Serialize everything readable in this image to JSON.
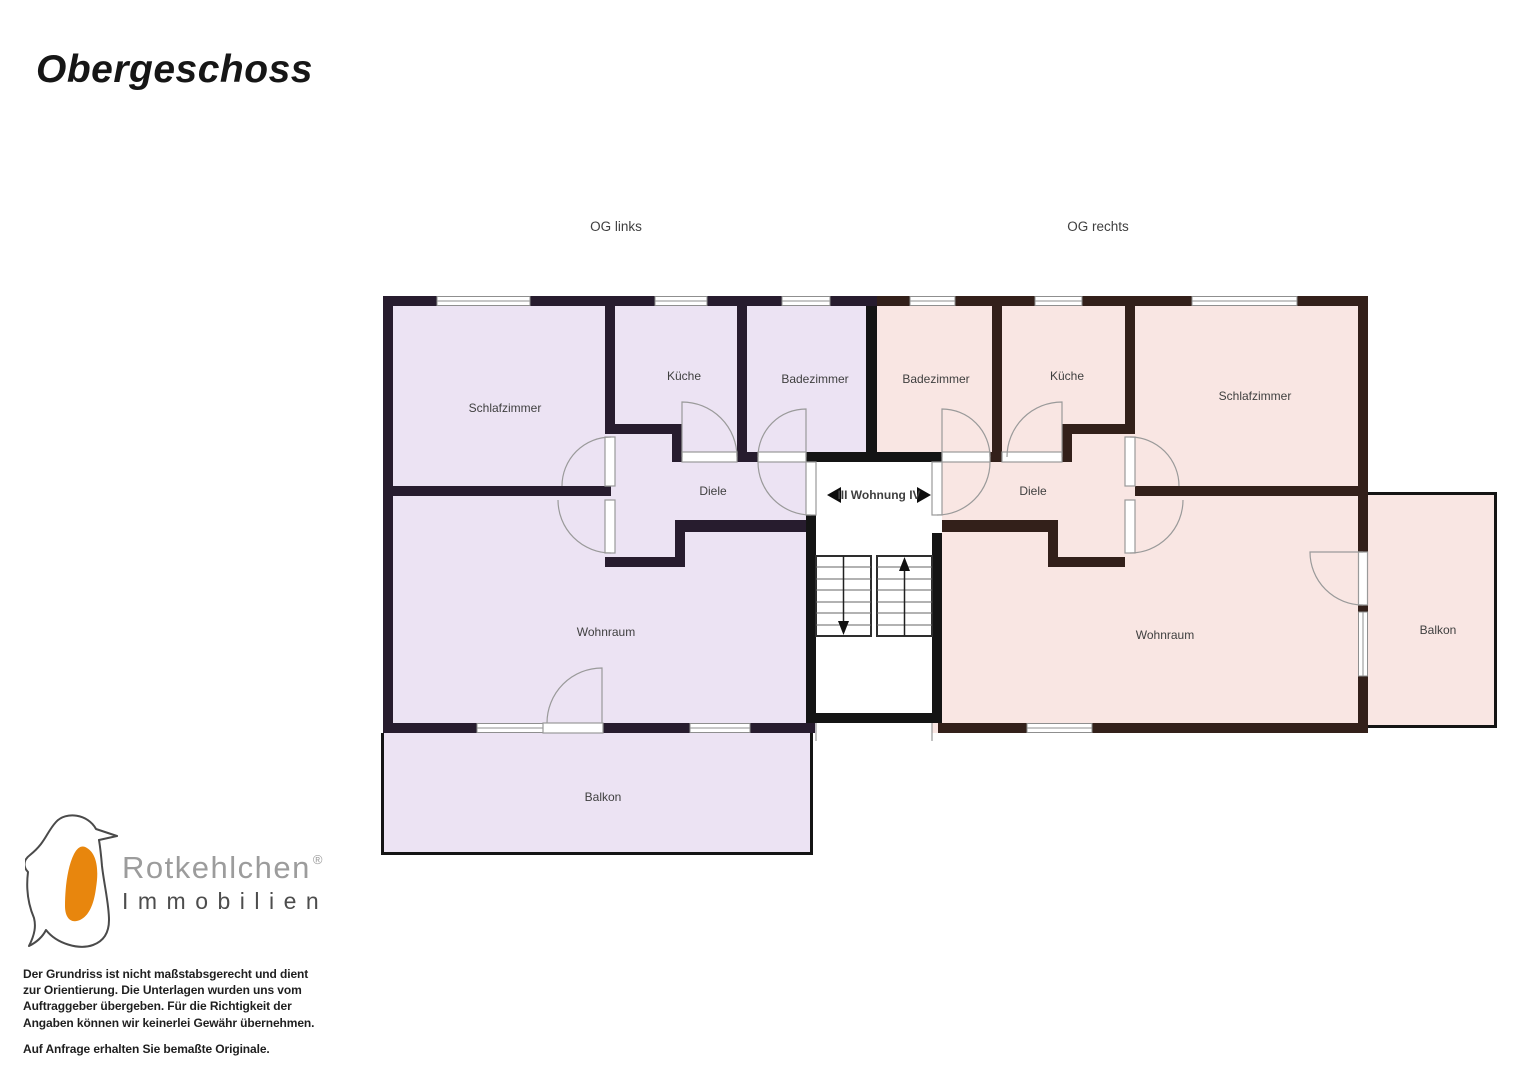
{
  "page": {
    "title": "Obergeschoss"
  },
  "plan": {
    "og_links": "OG links",
    "og_rechts": "OG rechts",
    "stairwell_label": "III Wohnung IV",
    "left": {
      "schlafzimmer": "Schlafzimmer",
      "kueche": "Küche",
      "badezimmer": "Badezimmer",
      "diele": "Diele",
      "wohnraum": "Wohnraum",
      "balkon": "Balkon"
    },
    "right": {
      "badezimmer": "Badezimmer",
      "kueche": "Küche",
      "schlafzimmer": "Schlafzimmer",
      "diele": "Diele",
      "wohnraum": "Wohnraum",
      "balkon": "Balkon"
    }
  },
  "colors": {
    "left_apartment_fill": "#ece3f3",
    "left_apartment_wall": "#271c2e",
    "right_apartment_fill": "#f9e6e3",
    "right_apartment_wall": "#33201a",
    "stair_wall": "#141414",
    "logo_orange": "#e8860d"
  },
  "icons": {
    "wohnung_arrow_left": "◀",
    "wohnung_arrow_right": "▶",
    "stairs_up_arrow": "↑",
    "stairs_down_arrow": "↓",
    "bird_logo": "rotkehlchen-bird"
  },
  "logo": {
    "brand": "Rotkehlchen",
    "registered": "®",
    "line2": "Immobilien"
  },
  "disclaimer": {
    "paragraph1": "Der Grundriss ist nicht maßstabsgerecht und dient\nzur Orientierung. Die Unterlagen wurden uns vom\nAuftraggeber übergeben. Für die Richtigkeit der\nAngaben können wir keinerlei Gewähr übernehmen.",
    "paragraph2": "Auf Anfrage erhalten Sie bemaßte Originale."
  }
}
